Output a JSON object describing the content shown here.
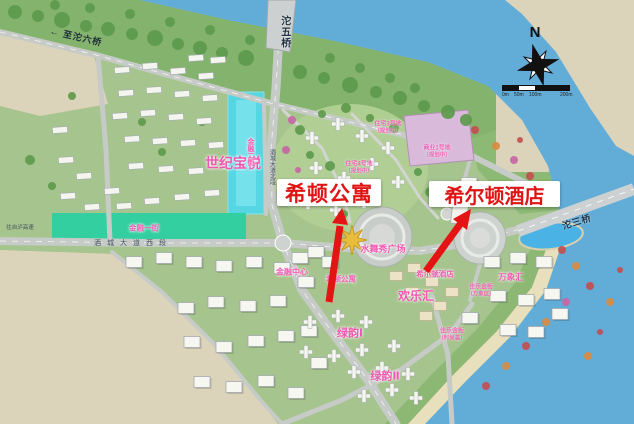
{
  "compass": {
    "north": "N"
  },
  "scale_bar": {
    "labels": [
      "0m",
      "50m",
      "100m",
      "200m"
    ]
  },
  "callouts": {
    "apartment": "希顿公寓",
    "hotel": "希尔顿酒店"
  },
  "colors": {
    "callout_red": "#e01414",
    "label_pink": "#f05ab2",
    "river_blue": "#62acd8",
    "canal_cyan": "#55d6e2",
    "strip_teal": "#34cfa0"
  },
  "map_labels": [
    {
      "id": "to-tuoliu-bridge",
      "text": "至沱六桥",
      "prefix": "←",
      "x": 76,
      "y": 37,
      "style": "road-dark",
      "size": 9,
      "rotate": 13,
      "spacing": 1
    },
    {
      "id": "tuowu-bridge",
      "text": "沱五桥",
      "x": 284,
      "y": 32,
      "style": "bridge",
      "size": 10,
      "vertical": true
    },
    {
      "id": "shiji-baoyue",
      "text": "世纪宝悦",
      "x": 233,
      "y": 163,
      "style": "pink-lg",
      "size": 14
    },
    {
      "id": "jinrong-2nd-street",
      "text": "金融二街",
      "x": 250,
      "y": 152,
      "style": "pink",
      "size": 7,
      "vertical": true
    },
    {
      "id": "jiucheng-avenue-north",
      "text": "酒城大道北段",
      "x": 271,
      "y": 167,
      "style": "road",
      "size": 6,
      "vertical": true
    },
    {
      "id": "jinrong-1st-street",
      "text": "金融一街",
      "x": 144,
      "y": 229,
      "style": "pink",
      "size": 7.5
    },
    {
      "id": "jiucheng-avenue-west",
      "text": "酒城大道西段",
      "x": 133,
      "y": 244,
      "style": "road",
      "size": 7,
      "spacing": 6
    },
    {
      "id": "to-zilu-expressway",
      "text": "往自泸高速",
      "x": 20,
      "y": 228,
      "style": "road",
      "size": 5.5
    },
    {
      "id": "residential-plot-3",
      "text": "住宅3号地",
      "text2": "（规划中）",
      "x": 388,
      "y": 128,
      "style": "pink-sm"
    },
    {
      "id": "commercial-plot-1",
      "text": "商业1号地",
      "text2": "（规划中）",
      "x": 437,
      "y": 152,
      "style": "pink-sm"
    },
    {
      "id": "residential-plot-4",
      "text": "住宅4号地",
      "text2": "（规划中）",
      "x": 359,
      "y": 168,
      "style": "pink-sm"
    },
    {
      "id": "water-show-plaza",
      "text": "水舞秀广场",
      "x": 383,
      "y": 249,
      "style": "pink",
      "size": 9
    },
    {
      "id": "financial-center",
      "text": "金融中心",
      "x": 292,
      "y": 272,
      "style": "pink",
      "size": 8
    },
    {
      "id": "xidun-apartment-map",
      "text": "希顿公寓",
      "x": 341,
      "y": 280,
      "style": "pink",
      "size": 7.5
    },
    {
      "id": "hilton-hotel-map",
      "text": "希尔顿酒店",
      "x": 435,
      "y": 275,
      "style": "pink",
      "size": 7.5
    },
    {
      "id": "huanle-hui",
      "text": "欢乐汇",
      "x": 416,
      "y": 297,
      "style": "pink-lg",
      "size": 12
    },
    {
      "id": "wanxiang-hui",
      "text": "万象汇",
      "x": 511,
      "y": 278,
      "style": "pink",
      "size": 8.5
    },
    {
      "id": "jiale-gold-street",
      "text": "佳乐金街",
      "text2": "（万象区）",
      "x": 481,
      "y": 291,
      "style": "pink-sm"
    },
    {
      "id": "jiale-gold-street-fashion",
      "text": "佳乐金街",
      "text2": "（时尚荟）",
      "x": 452,
      "y": 335,
      "style": "pink-sm"
    },
    {
      "id": "green-rhyme-1",
      "text": "绿韵Ⅰ",
      "x": 350,
      "y": 334,
      "style": "pink-lg",
      "size": 11
    },
    {
      "id": "green-rhyme-2",
      "text": "绿韵Ⅱ",
      "x": 385,
      "y": 377,
      "style": "pink-lg",
      "size": 11
    },
    {
      "id": "tuosan-bridge",
      "text": "沱三桥",
      "x": 577,
      "y": 222,
      "style": "bridge",
      "size": 9,
      "rotate": -17
    }
  ]
}
